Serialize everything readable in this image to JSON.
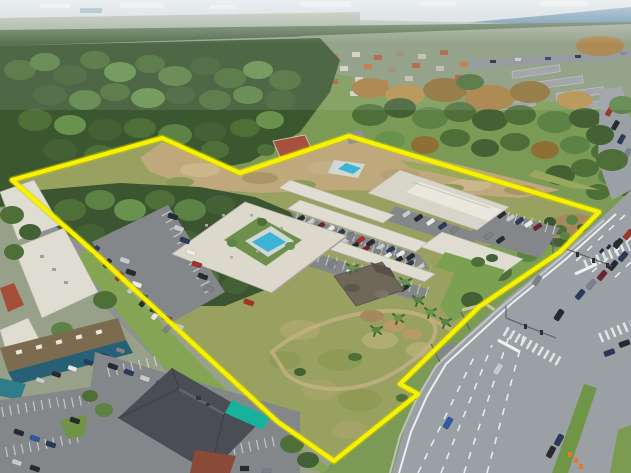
{
  "meta": {
    "title": "Aerial drone photograph of commercial property with highlighted parcel boundary",
    "scene_type": "aerial-photograph",
    "no_visible_text": true
  },
  "boundary": {
    "name": "parcel-boundary-outline",
    "color": "#f7f300",
    "glow_color": "#d2cc00",
    "points": "12,180 162,138 240,173 349,136 599,212 560,252 480,306 400,384 418,394 334,461 278,422 200,350 95,253"
  },
  "palette": {
    "sky_haze": "#ccd5d8",
    "water": "#4f7d9e",
    "forest": "#3b572f",
    "field_tan": "#bfa97c",
    "rough_grass": "#99a161",
    "lawn": "#7ba052",
    "roof_white": "#ddd8cc",
    "roof_warehouse": "#d7d4c8",
    "asphalt_lot": "#83878a",
    "road": "#9aa0a4",
    "median_grass": "#6f9647",
    "pool": "#3eb3d8",
    "awning_teal": "#17b29b",
    "restaurant_roof": "#4a4e54",
    "strip_mall_roof": "#7d6b50",
    "storefront_teal": "#275f74",
    "brick": "#8a4a38",
    "mulch": "#a5895c",
    "barrel_orange": "#e07b28"
  },
  "features": {
    "parcel": "yellow outlined development parcel",
    "square_building": "courtyard apartment building with swimming pool",
    "complex": "flex office / apartment complex with parking rows",
    "pool_main": "main swimming pool",
    "pool_secondary": "secondary pool",
    "derelict_building": "vacant flat-roof building",
    "rough_field": "overgrown grass field with dirt loop path",
    "highway": "six-lane divided highway",
    "intersection": "signalized intersection with crosswalks",
    "restaurant": "hip-roof restaurant with teal awning",
    "strip_mall": "strip mall with teal storefront canopy",
    "industrial": "white-roof industrial buildings",
    "suburb": "distant residential subdivisions",
    "lake": "lake on horizon",
    "forest": "surrounding woodland"
  }
}
